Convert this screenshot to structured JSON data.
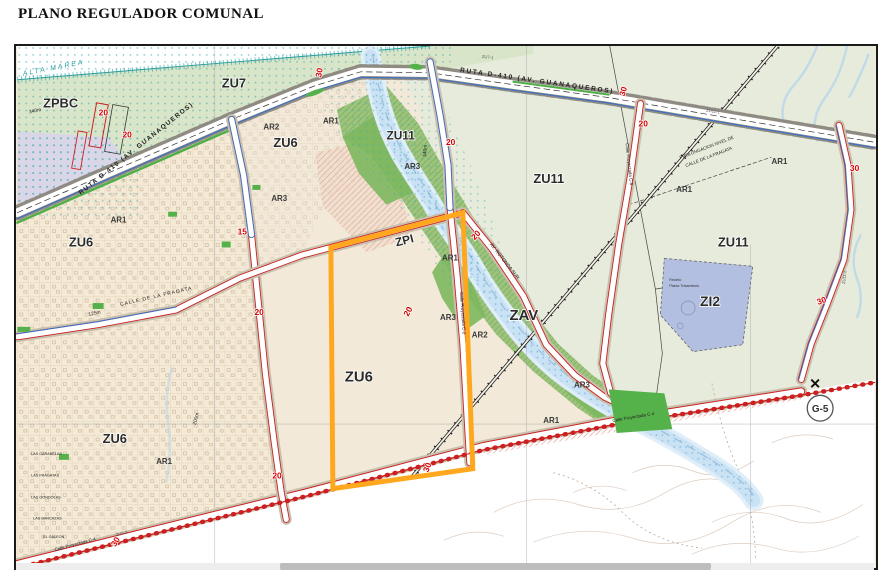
{
  "title": "PLANO REGULADOR COMUNAL",
  "map": {
    "highlight_color": "#FFA81E",
    "colors": {
      "urban_zone": "#f4ead6",
      "coastal_green": "#d9e5c8",
      "rural_zone": "#e7ebdb",
      "valley_green": "#9cc47c",
      "park_green": "#55b24a",
      "river_blue": "#c9e2f4",
      "road_red": "#cc2020",
      "road_blue": "#3b6fc4",
      "number_red": "#d40000",
      "protected_lavender": "#d8d3ec",
      "industrial_blue": "#b3bfe0",
      "shore_teal": "#3aa8a8"
    },
    "annotations": {
      "grid_ref": "G-5",
      "boundary_mark": "✕"
    },
    "zone_labels": [
      {
        "t": "ZPBC",
        "x": 26,
        "y": 62,
        "s": 13
      },
      {
        "t": "ZU7",
        "x": 206,
        "y": 42,
        "s": 13
      },
      {
        "t": "ZU6",
        "x": 258,
        "y": 102,
        "s": 13
      },
      {
        "t": "ZU6",
        "x": 52,
        "y": 202,
        "s": 13
      },
      {
        "t": "ZU6",
        "x": 330,
        "y": 338,
        "s": 15
      },
      {
        "t": "ZU6",
        "x": 86,
        "y": 400,
        "s": 13
      },
      {
        "t": "ZU11",
        "x": 372,
        "y": 94,
        "s": 12
      },
      {
        "t": "ZU11",
        "x": 520,
        "y": 138,
        "s": 13
      },
      {
        "t": "ZU11",
        "x": 706,
        "y": 202,
        "s": 13
      },
      {
        "t": "ZI2",
        "x": 688,
        "y": 262,
        "s": 14
      },
      {
        "t": "ZAV",
        "x": 496,
        "y": 276,
        "s": 15
      },
      {
        "t": "ZPI",
        "x": 382,
        "y": 202,
        "s": 12,
        "r": -14
      }
    ],
    "area_labels": [
      {
        "t": "AR1",
        "x": 94,
        "y": 178
      },
      {
        "t": "AR2",
        "x": 248,
        "y": 84
      },
      {
        "t": "AR3",
        "x": 256,
        "y": 156
      },
      {
        "t": "AR1",
        "x": 308,
        "y": 78
      },
      {
        "t": "AR3",
        "x": 390,
        "y": 124
      },
      {
        "t": "AR1",
        "x": 428,
        "y": 216
      },
      {
        "t": "AR3",
        "x": 426,
        "y": 276
      },
      {
        "t": "AR2",
        "x": 458,
        "y": 294
      },
      {
        "t": "AR3",
        "x": 561,
        "y": 344
      },
      {
        "t": "AR1",
        "x": 530,
        "y": 380
      },
      {
        "t": "AR1",
        "x": 140,
        "y": 421
      },
      {
        "t": "AR1",
        "x": 664,
        "y": 147
      },
      {
        "t": "AR1",
        "x": 760,
        "y": 119
      }
    ],
    "road_numbers": [
      {
        "t": "20",
        "x": 82,
        "y": 70
      },
      {
        "t": "20",
        "x": 106,
        "y": 92
      },
      {
        "t": "15",
        "x": 222,
        "y": 190
      },
      {
        "t": "20",
        "x": 239,
        "y": 271
      },
      {
        "t": "20",
        "x": 257,
        "y": 436
      },
      {
        "t": "30",
        "x": 306,
        "y": 32,
        "r": -78
      },
      {
        "t": "20",
        "x": 432,
        "y": 100
      },
      {
        "t": "20",
        "x": 461,
        "y": 196,
        "r": -48
      },
      {
        "t": "20",
        "x": 394,
        "y": 273,
        "r": -62
      },
      {
        "t": "20",
        "x": 626,
        "y": 81
      },
      {
        "t": "30",
        "x": 839,
        "y": 126
      },
      {
        "t": "30",
        "x": 807,
        "y": 261,
        "r": -20
      },
      {
        "t": "30",
        "x": 414,
        "y": 430,
        "r": -68
      },
      {
        "t": "30",
        "x": 99,
        "y": 505,
        "r": -60
      },
      {
        "t": "30",
        "x": 612,
        "y": 51,
        "r": -75
      }
    ],
    "street_labels": [
      {
        "t": "RUTA D-410 (AV. GUANAQUEROS)",
        "x": 64,
        "y": 150,
        "r": -38.5,
        "s": 6.5,
        "ls": 1.4,
        "b": 1
      },
      {
        "t": "RUTA D-410 (AV. GUANAQUEROS)",
        "x": 446,
        "y": 26,
        "r": 8,
        "s": 6.5,
        "ls": 1.8,
        "b": 1
      },
      {
        "t": "CALLE DE LA FRAGATA",
        "x": 104,
        "y": 262,
        "r": -13,
        "s": 5,
        "ls": 1
      },
      {
        "t": "AV. ROTONDA SUR",
        "x": 476,
        "y": 200,
        "r": 52,
        "s": 5
      },
      {
        "t": "Calle Proyectada C-2",
        "x": 446,
        "y": 248,
        "r": 86,
        "s": 4.5
      },
      {
        "t": "Calle Proyectada C-6",
        "x": 613,
        "y": 98,
        "r": 84,
        "s": 4.5
      },
      {
        "t": "Calle Proyectada C-4",
        "x": 38,
        "y": 509,
        "r": -15,
        "s": 4.5
      },
      {
        "t": "Calle Proyectada C-4",
        "x": 600,
        "y": 379,
        "r": -10,
        "s": 4.5
      },
      {
        "t": "PROLONGACION NIVEL DE",
        "x": 668,
        "y": 114,
        "r": -21,
        "s": 4.5
      },
      {
        "t": "CALLE DE LA FRAGATA",
        "x": 674,
        "y": 122,
        "r": -21,
        "s": 4.5
      },
      {
        "t": "ALTA MAREA",
        "x": 6,
        "y": 30,
        "r": -11,
        "s": 7,
        "i": 1,
        "c": "#2a9d9d",
        "ls": 2
      },
      {
        "t": "340m",
        "x": 12,
        "y": 68,
        "r": -12,
        "s": 5
      },
      {
        "t": "340m",
        "x": 412,
        "y": 112,
        "r": -86,
        "s": 5
      },
      {
        "t": "125m",
        "x": 72,
        "y": 272,
        "r": -12,
        "s": 5
      },
      {
        "t": "200m",
        "x": 180,
        "y": 382,
        "r": -76,
        "s": 5
      },
      {
        "t": "ZU7-1",
        "x": 468,
        "y": 12,
        "r": 6,
        "s": 4.2,
        "c": "#555"
      },
      {
        "t": "ZU11-1",
        "x": 694,
        "y": 66,
        "r": 9,
        "s": 4.2,
        "c": "#555"
      },
      {
        "t": "ZU11-2",
        "x": 834,
        "y": 240,
        "r": -84,
        "s": 4.2,
        "c": "#555"
      },
      {
        "t": "ZU6-3",
        "x": 100,
        "y": 494,
        "r": -15,
        "s": 4.2,
        "c": "#555"
      },
      {
        "t": "LAS CARABELAS",
        "x": 14,
        "y": 412,
        "s": 3.8
      },
      {
        "t": "LAS FRAGATAS",
        "x": 14,
        "y": 434,
        "s": 3.8
      },
      {
        "t": "LAS GONDOLAS",
        "x": 14,
        "y": 456,
        "s": 3.8
      },
      {
        "t": "LAS BARCAZAS",
        "x": 16,
        "y": 477,
        "s": 3.8
      },
      {
        "t": "EL GALEON",
        "x": 26,
        "y": 496,
        "s": 3.8
      },
      {
        "t": "Recinto",
        "x": 657,
        "y": 237,
        "s": 3.6,
        "c": "#333"
      },
      {
        "t": "Planta Tratamiento",
        "x": 657,
        "y": 243,
        "s": 3.6,
        "c": "#333"
      }
    ]
  }
}
